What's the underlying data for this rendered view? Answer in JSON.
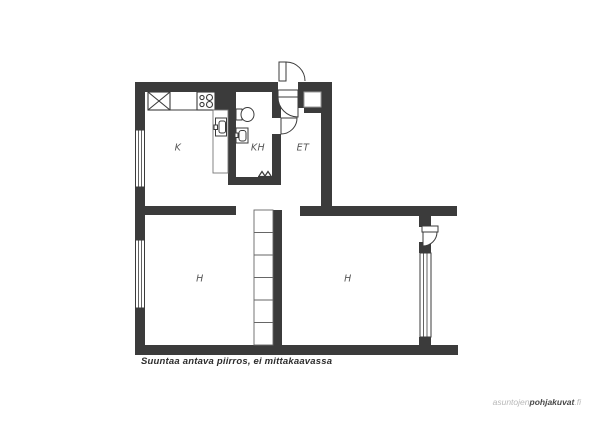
{
  "plan": {
    "room_labels": {
      "kitchen": "K",
      "bathroom": "KH",
      "entry": "ET",
      "room_left": "H",
      "room_right": "H"
    },
    "caption": "Suuntaa antava piirros, ei mittakaavassa"
  },
  "watermark": {
    "prefix": "asuntojen",
    "brand": "pohjakuvat",
    "tld": ".fi"
  },
  "colors": {
    "wall": "#3b3b3b",
    "room_label": "#565656",
    "caption": "#2d2d2d",
    "watermark_light": "#b8b8b8",
    "watermark_dark": "#484848",
    "background": "#ffffff"
  }
}
